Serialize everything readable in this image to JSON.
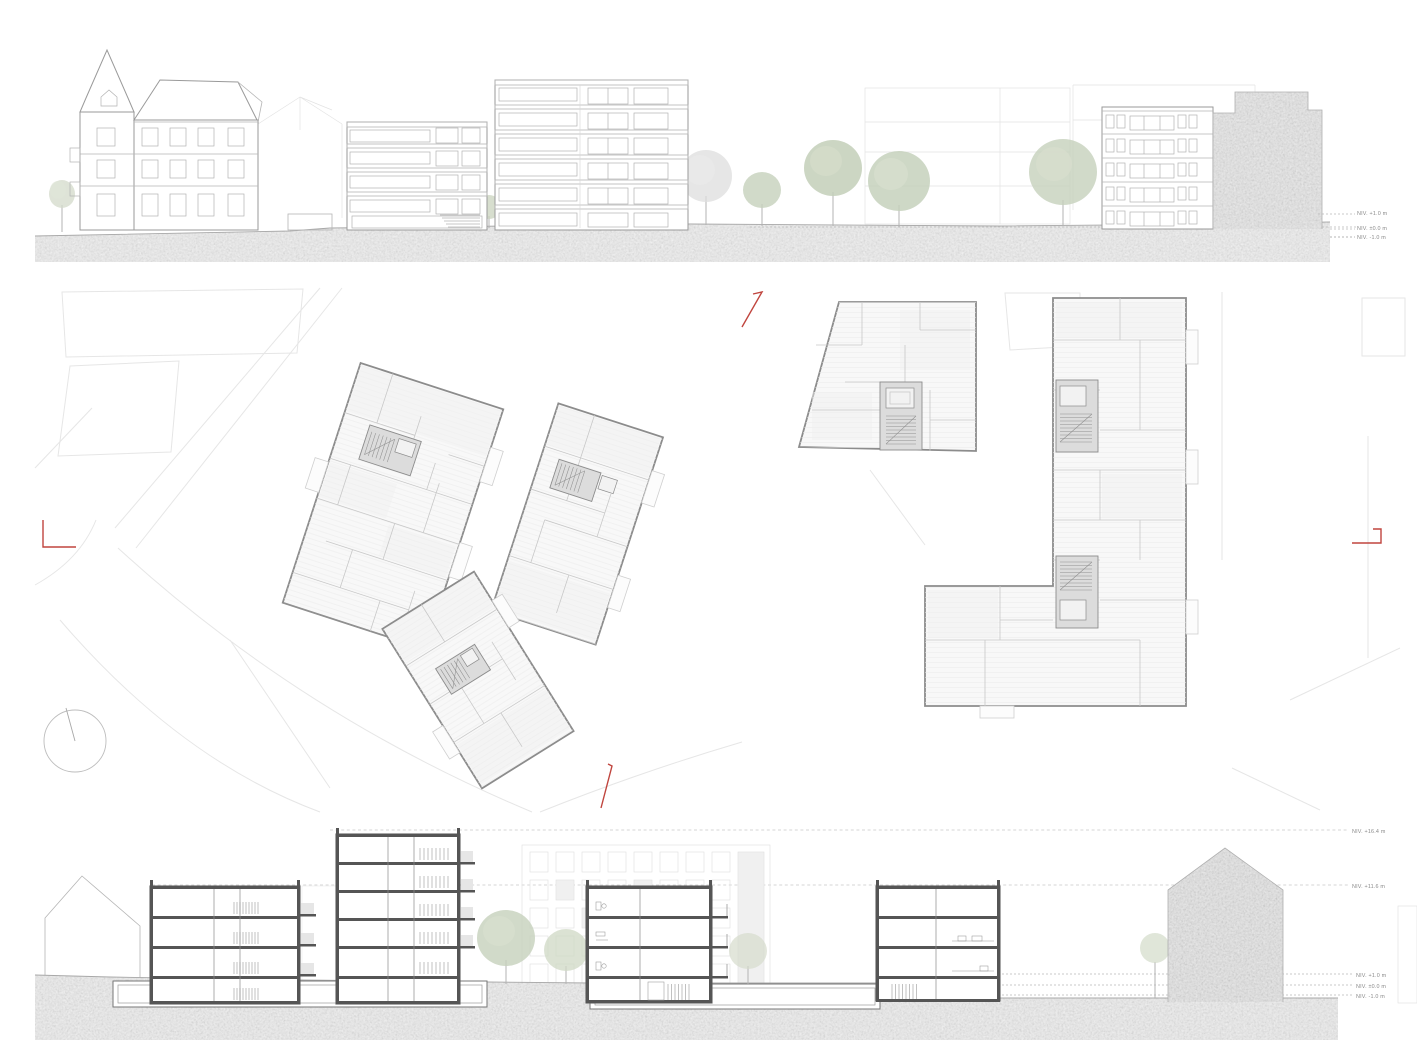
{
  "sheet": {
    "panels": {
      "top": "street-elevation",
      "middle": "site-plan",
      "bottom": "cross-section"
    },
    "colors": {
      "section_marker_red": "#c0453e",
      "earth_gray": "#d2d2d2",
      "mass_gray": "#cbcbcb",
      "tree_green": "#c6d1bc",
      "drawing_line_gray": "#9a9a9a"
    },
    "levels_elevation": [
      {
        "label": "NIV. +1.0 m"
      },
      {
        "label": "NIV. ±0.0 m"
      },
      {
        "label": "NIV. -1.0 m"
      }
    ],
    "levels_section": [
      {
        "label": "NIV. +16.4 m"
      },
      {
        "label": "NIV. +11.6 m"
      },
      {
        "label": "NIV. +1.0 m"
      },
      {
        "label": "NIV. ±0.0 m"
      },
      {
        "label": "NIV. -1.0 m"
      }
    ]
  }
}
